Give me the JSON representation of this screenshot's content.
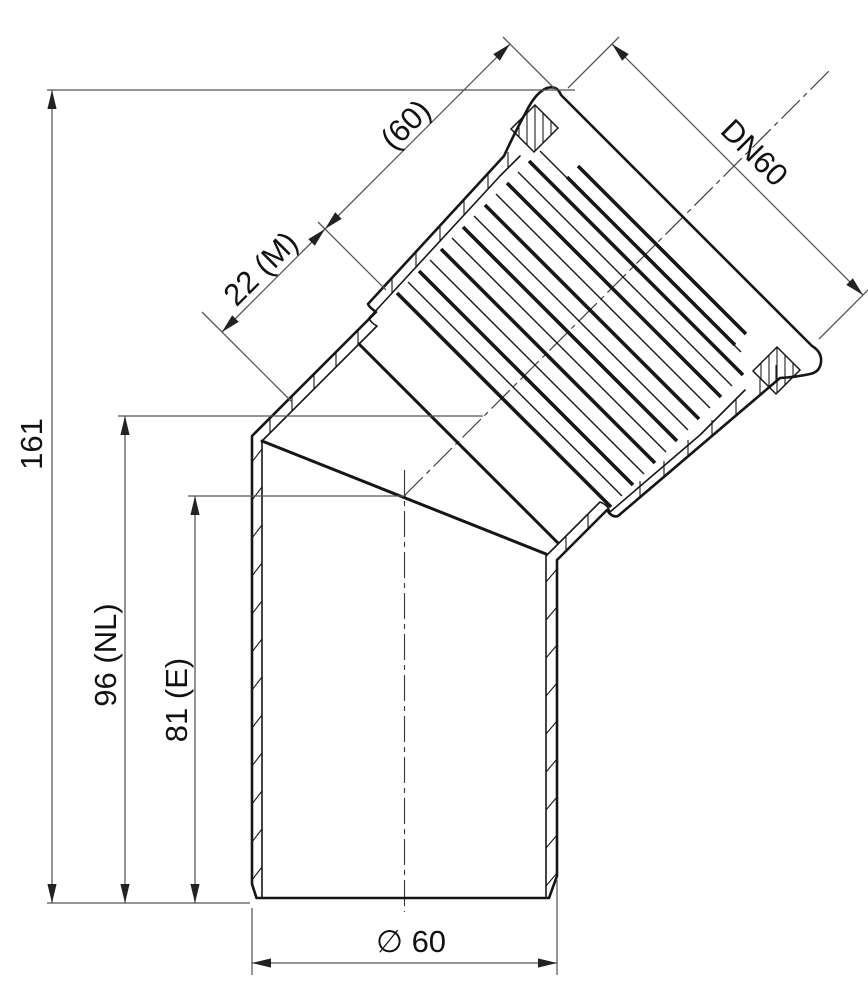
{
  "drawing": {
    "kind": "pipe-fitting-section-drawing",
    "colors": {
      "background": "#ffffff",
      "part_line": "#161616",
      "dim_line": "#555555",
      "centerline": "#3a3a3a",
      "arrow": "#222222",
      "label": "#111111"
    },
    "dimensions": {
      "overall_height": "161",
      "length_nl": "96 (NL)",
      "length_e": "81 (E)",
      "depth_m": "22 (M)",
      "socket_length_ref": "(60)",
      "nominal_diameter": "DN60",
      "outer_diameter": "∅ 60"
    }
  }
}
